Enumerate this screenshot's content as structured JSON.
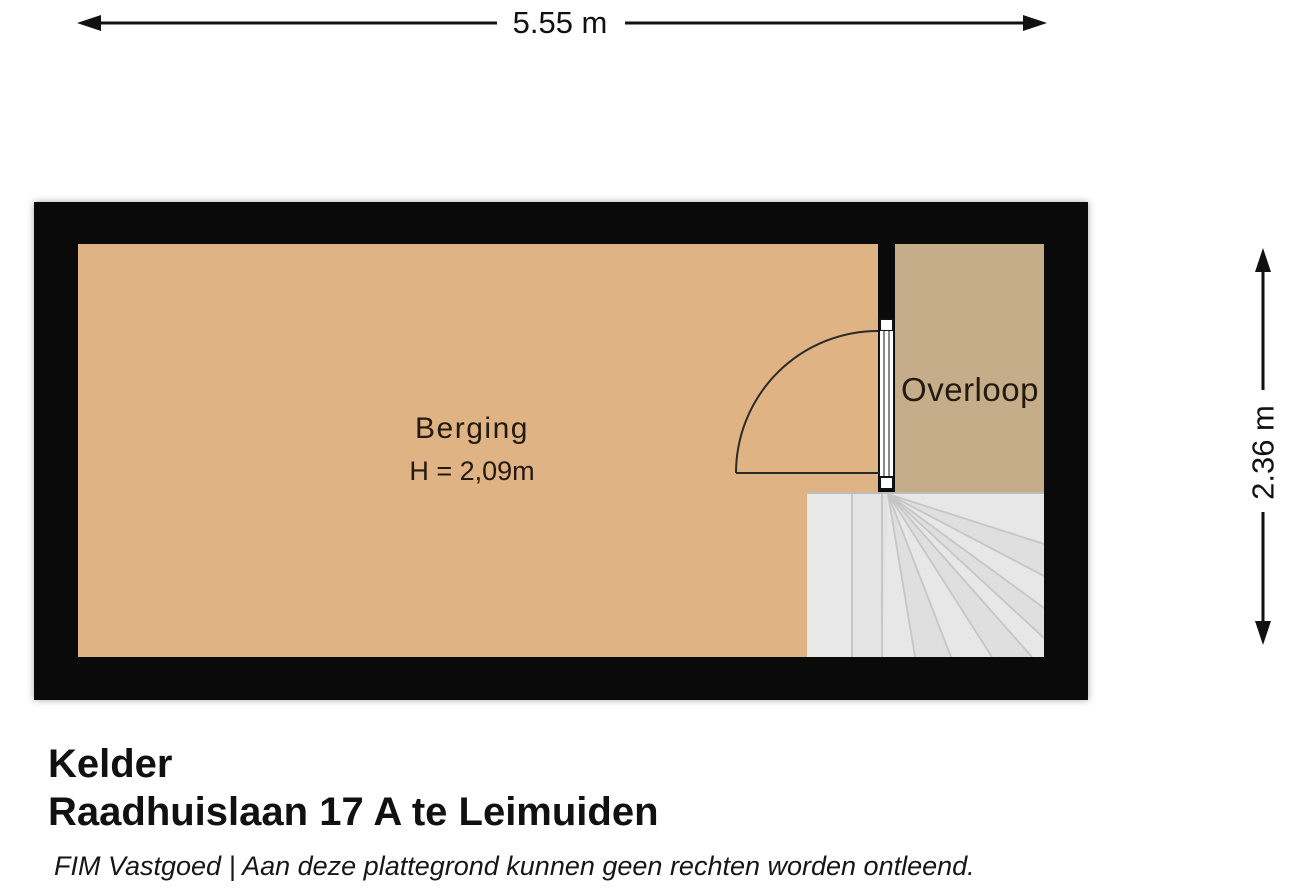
{
  "dimensions": {
    "width": "5.55 m",
    "height": "2.36 m"
  },
  "rooms": [
    {
      "name": "Berging",
      "ceiling_height": "H = 2,09m",
      "floor_color": "#dfb384"
    },
    {
      "name": "Overloop",
      "floor_color": "#c6ad89"
    }
  ],
  "features": {
    "door": "swing-door",
    "stairs": "winder-staircase"
  },
  "title_block": {
    "floor": "Kelder",
    "address": "Raadhuislaan 17 A te Leimuiden",
    "disclaimer": "FIM Vastgoed | Aan deze plattegrond kunnen geen rechten worden ontleend."
  },
  "colors": {
    "wall": "#0a0a0a",
    "berging_floor": "#dfb384",
    "overloop_floor": "#c6ad89",
    "stair_fill": "#e2e2e2",
    "stair_line": "#c6c6c6",
    "background": "#ffffff",
    "text": "#1a1a1a"
  }
}
